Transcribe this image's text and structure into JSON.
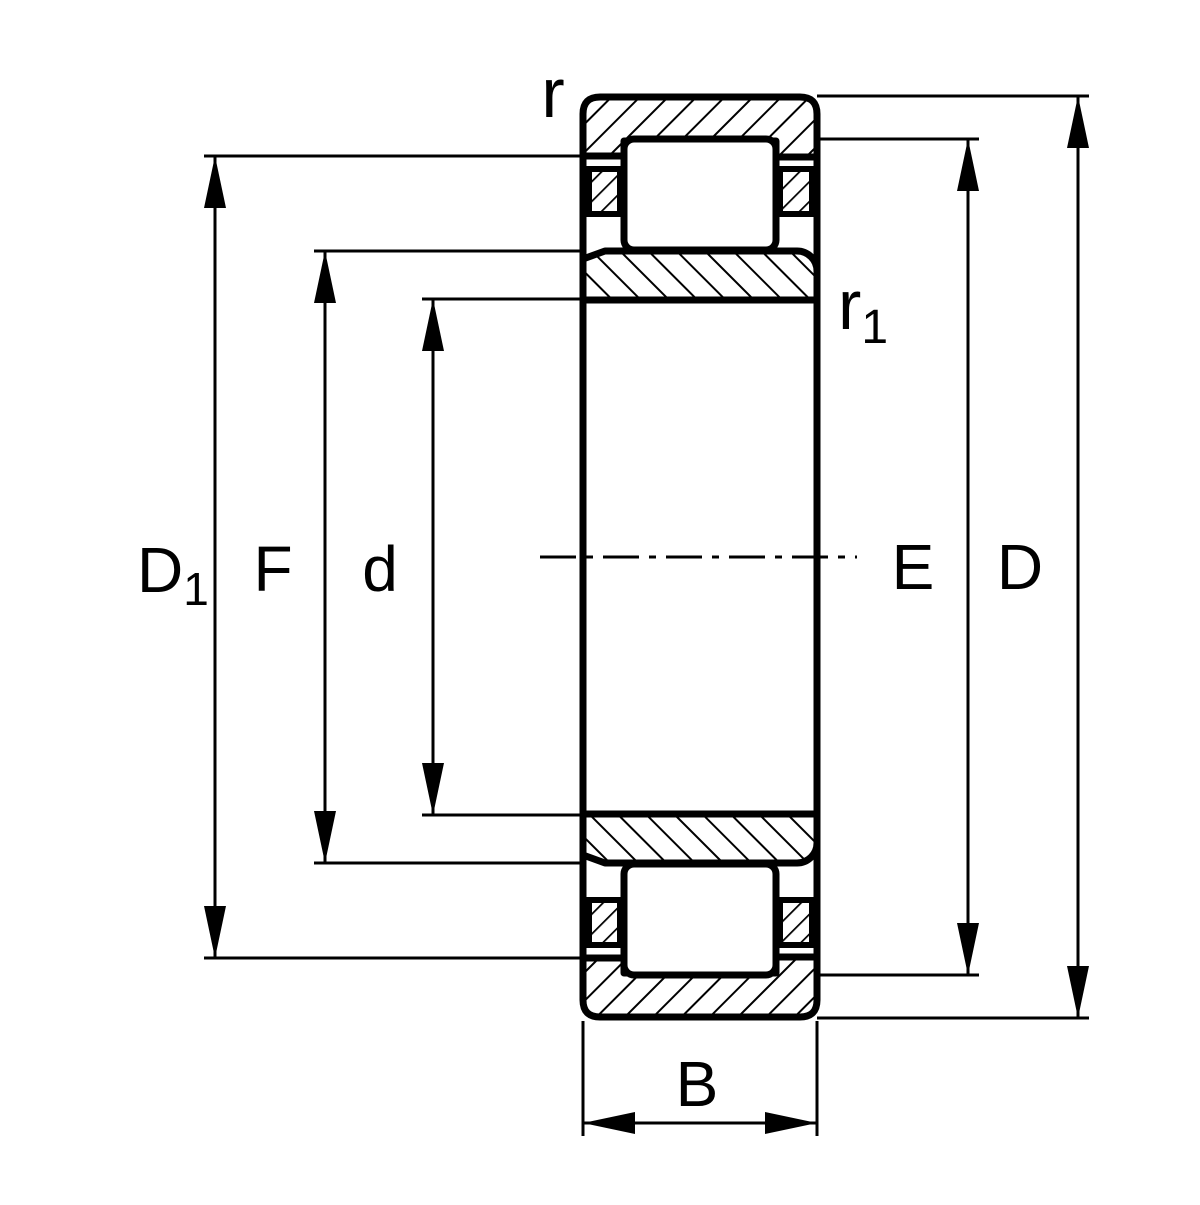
{
  "diagram": {
    "kind": "bearing-cross-section-technical-drawing",
    "dimension_symbols": [
      "r",
      "r1",
      "D1",
      "F",
      "d",
      "E",
      "D",
      "B"
    ],
    "labels": {
      "r": "r",
      "r1": {
        "base": "r",
        "sub": "1"
      },
      "D1": {
        "base": "D",
        "sub": "1"
      },
      "F": "F",
      "d": "d",
      "E": "E",
      "D": "D",
      "B": "B"
    },
    "colors": {
      "ink": "#000000",
      "paper": "#ffffff"
    }
  }
}
